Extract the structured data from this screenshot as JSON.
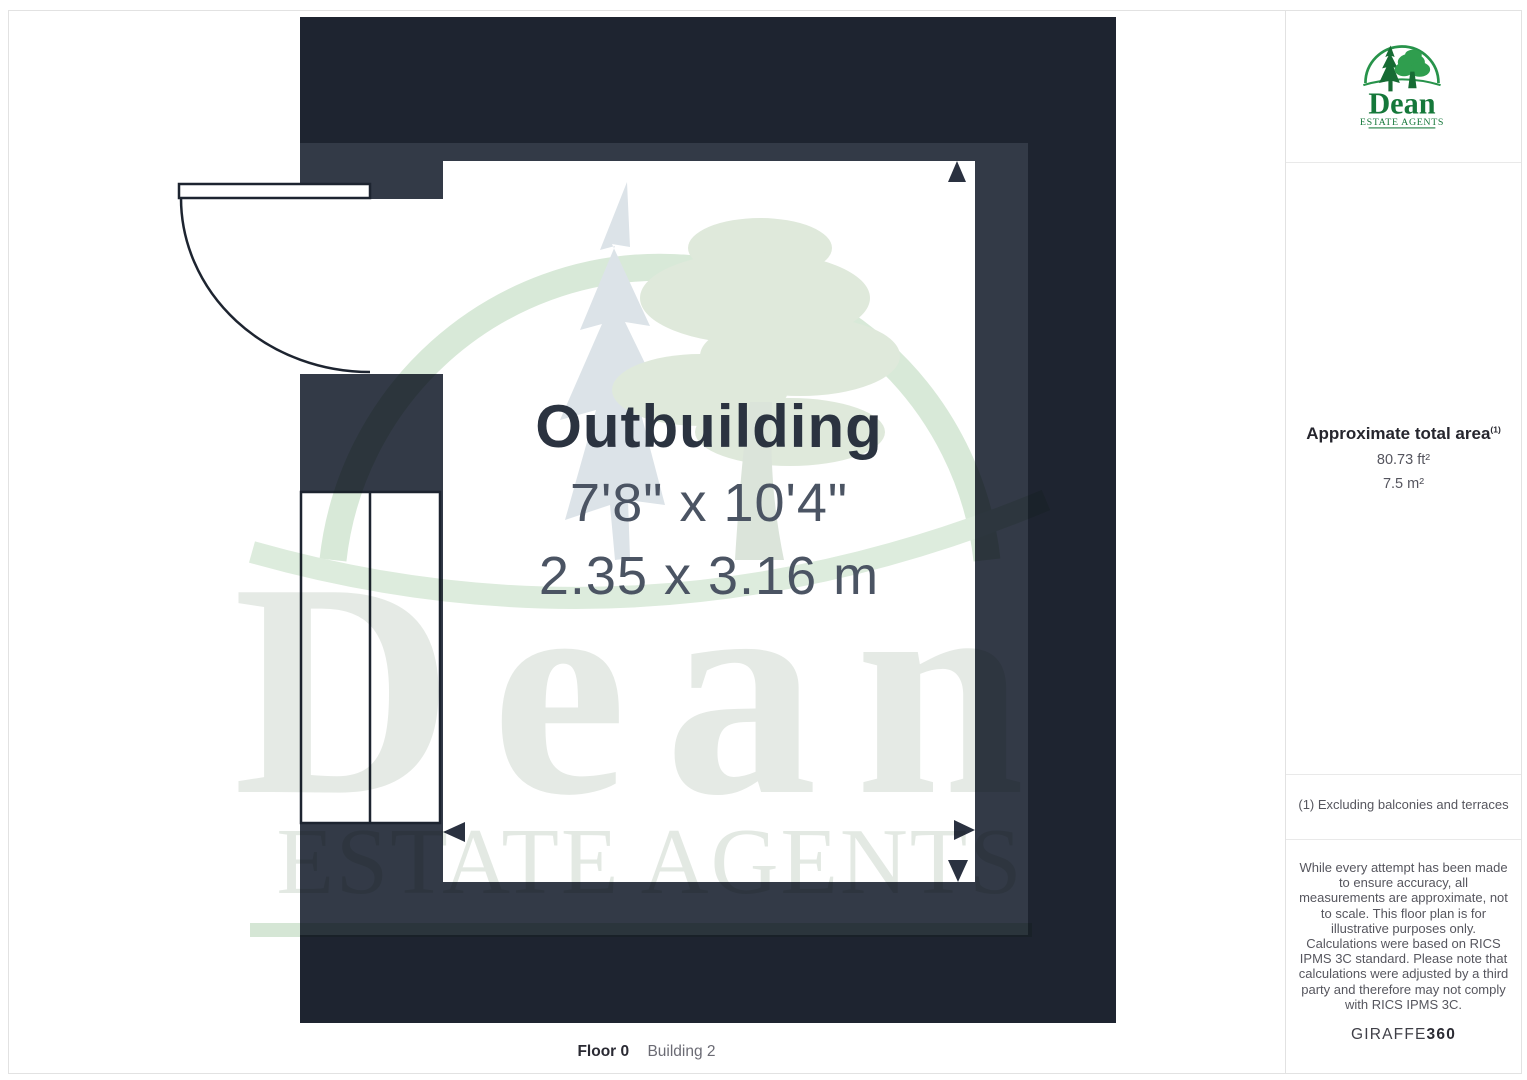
{
  "plan": {
    "room": {
      "name": "Outbuilding",
      "dims_imperial": "7'8\" x 10'4\"",
      "dims_metric": "2.35 x 3.16 m"
    },
    "caption": {
      "floor": "Floor 0",
      "building": "Building 2"
    }
  },
  "watermark": {
    "name": "Dean",
    "tagline": "ESTATE AGENTS"
  },
  "sidebar": {
    "logo": {
      "name": "Dean",
      "tagline": "ESTATE AGENTS"
    },
    "area": {
      "title": "Approximate total area",
      "footnote_ref": "(1)",
      "imperial": "80.73 ft²",
      "metric": "7.5 m²"
    },
    "footnote": "(1) Excluding balconies and terraces",
    "disclaimer_1": "While every attempt has been made to ensure accuracy, all measurements are approximate, not to scale. This floor plan is for illustrative purposes only.",
    "disclaimer_2": "Calculations were based on RICS IPMS 3C standard. Please note that calculations were adjusted by a third party and therefore may not comply with RICS IPMS 3C.",
    "brand": {
      "name": "GIRAFFE",
      "suffix": "360"
    }
  },
  "colors": {
    "wall_dark": "#1e2430",
    "wall_medium": "#333a47",
    "room_white": "#ffffff",
    "logo_green": "#15783a",
    "watermark_green": "#d8e9d8"
  }
}
